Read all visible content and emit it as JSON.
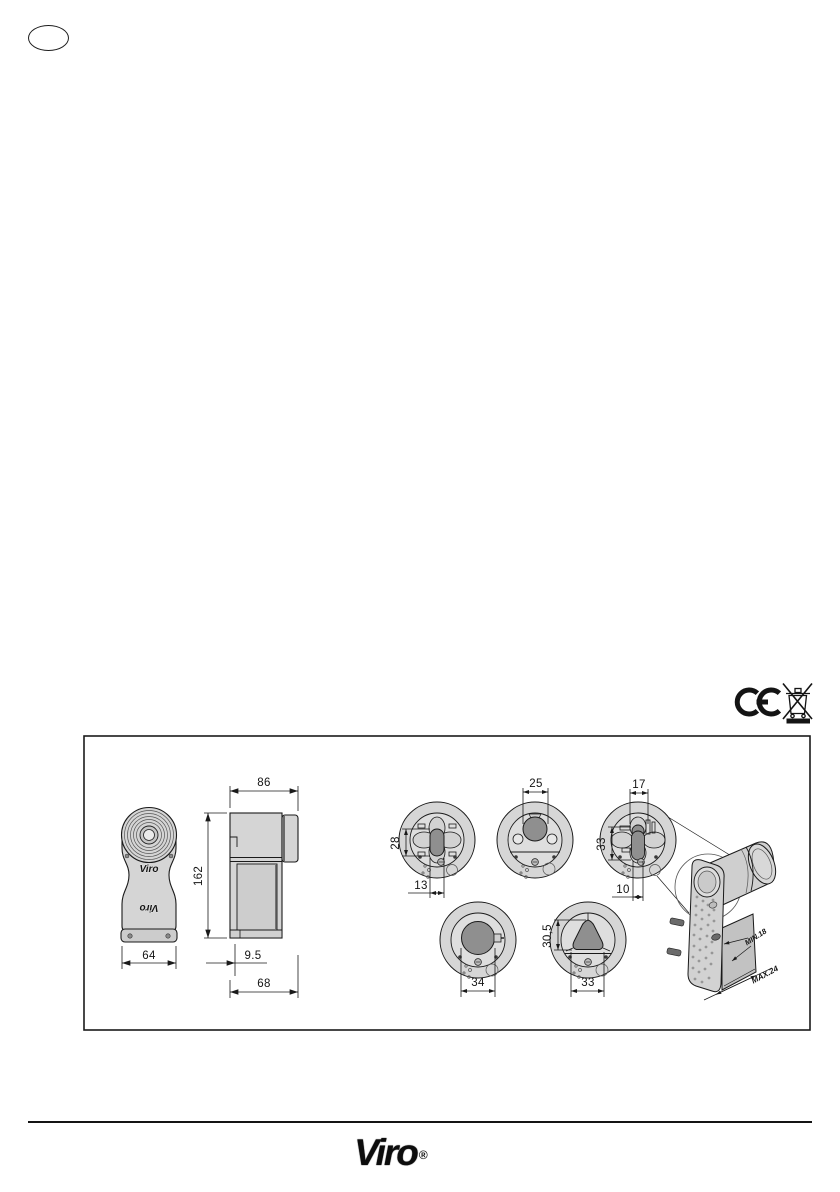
{
  "language_badge": {
    "label": ""
  },
  "compliance": {
    "ce_icon": "ce-mark",
    "weee_icon": "crossed-out-wheelie-bin"
  },
  "drawing_panel": {
    "front_view": {
      "brand_logo": "Viro",
      "width": "64"
    },
    "side_view": {
      "top_width": "86",
      "height": "162",
      "offset": "9.5",
      "bottom_width": "68"
    },
    "plates": [
      {
        "height": "28",
        "width": "13"
      },
      {
        "width": "25"
      },
      {
        "top_width": "17",
        "height": "33",
        "bottom_width": "10"
      },
      {
        "width": "34"
      },
      {
        "height": "30,5",
        "width": "33"
      }
    ],
    "iso_view": {
      "min_depth": "MIN.18",
      "max_depth": "MAX.24"
    }
  },
  "footer": {
    "brand": "Viro",
    "registered": "®"
  }
}
